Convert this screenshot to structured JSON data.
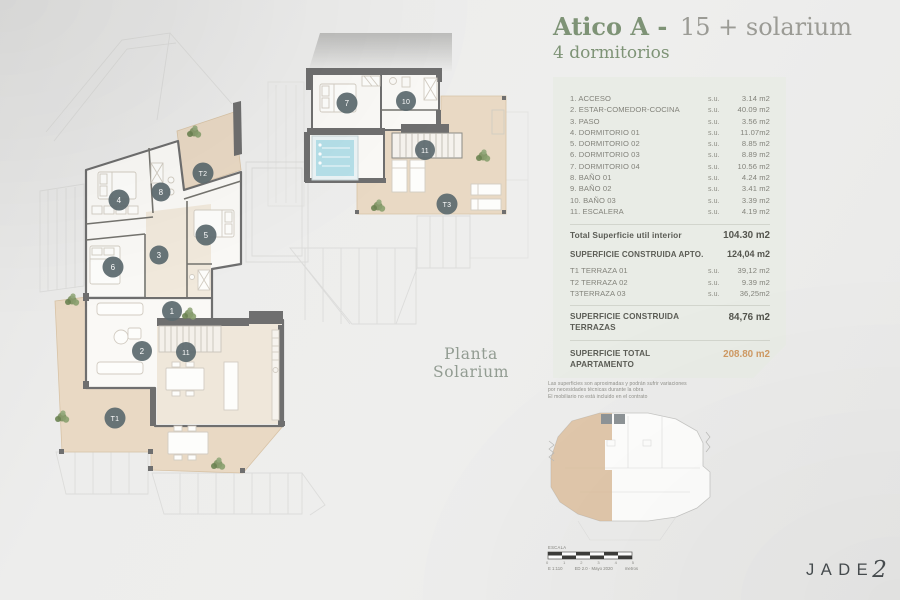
{
  "title": {
    "prefix": "Atico A -",
    "suffix": "15 + solarium",
    "subtitle": "4 dormitorios"
  },
  "panel": {
    "su": "s.u.",
    "rooms": [
      {
        "label": "1. ACCESO",
        "value": "3.14 m2"
      },
      {
        "label": "2. ESTAR-COMEDOR-COCINA",
        "value": "40.09 m2"
      },
      {
        "label": "3. PASO",
        "value": "3.56 m2"
      },
      {
        "label": "4. DORMITORIO 01",
        "value": "11.07m2"
      },
      {
        "label": "5. DORMITORIO 02",
        "value": "8.85 m2"
      },
      {
        "label": "6. DORMITORIO 03",
        "value": "8.89 m2"
      },
      {
        "label": "7. DORMITORIO 04",
        "value": "10.56 m2"
      },
      {
        "label": "8. BAÑO 01",
        "value": "4.24 m2"
      },
      {
        "label": "9. BAÑO 02",
        "value": "3.41 m2"
      },
      {
        "label": "10. BAÑO 03",
        "value": "3.39 m2"
      },
      {
        "label": "11. ESCALERA",
        "value": "4.19 m2"
      }
    ],
    "total_util": {
      "label": "Total Superficie util interior",
      "value": "104.30 m2"
    },
    "construida_apto": {
      "label": "SUPERFICIE CONSTRUIDA APTO.",
      "value": "124,04 m2"
    },
    "terrazas": [
      {
        "label": "T1 TERRAZA 01",
        "value": "39,12 m2"
      },
      {
        "label": "T2 TERRAZA 02",
        "value": "9.39 m2"
      },
      {
        "label": "T3TERRAZA 03",
        "value": "36,25m2"
      }
    ],
    "construida_terrazas": {
      "line1": "SUPERFICIE CONSTRUIDA",
      "line2": "TERRAZAS",
      "value": "84,76 m2"
    },
    "total_apartamento": {
      "line1": "SUPERFICIE TOTAL",
      "line2": "APARTAMENTO",
      "value": "208.80 m2"
    }
  },
  "disclaimer": [
    "Las superficies son aproximadas y podrán sufrir variaciones",
    "por necesidades técnicas durante la obra",
    "El mobiliario no está incluido en el contrato"
  ],
  "captions": {
    "solarium": "Planta Solarium"
  },
  "scale": {
    "label": "ESCALA",
    "ticks": [
      "0",
      "1",
      "2",
      "3",
      "4",
      "5"
    ],
    "ratio": "E 1:110",
    "edition": "ED 2.0 · Mayo 2020",
    "units": "metros"
  },
  "logo": {
    "word": "JADE",
    "number": "2"
  },
  "plans": {
    "main_markers": [
      "4",
      "8",
      "T2",
      "5",
      "3",
      "6",
      "1",
      "2",
      "11",
      "T1"
    ],
    "sol_markers": [
      "7",
      "10",
      "11",
      "T3"
    ]
  },
  "colors": {
    "accent_green": "#7e9376",
    "value_orange": "#cf9a63",
    "marker_fill": "#5c6b6f",
    "wall": "#6f6f6f",
    "terrace": "#e9d9c4",
    "pool": "#b5dfe8",
    "plant": "#7c9162",
    "panel_bg": "#e9ece6"
  }
}
